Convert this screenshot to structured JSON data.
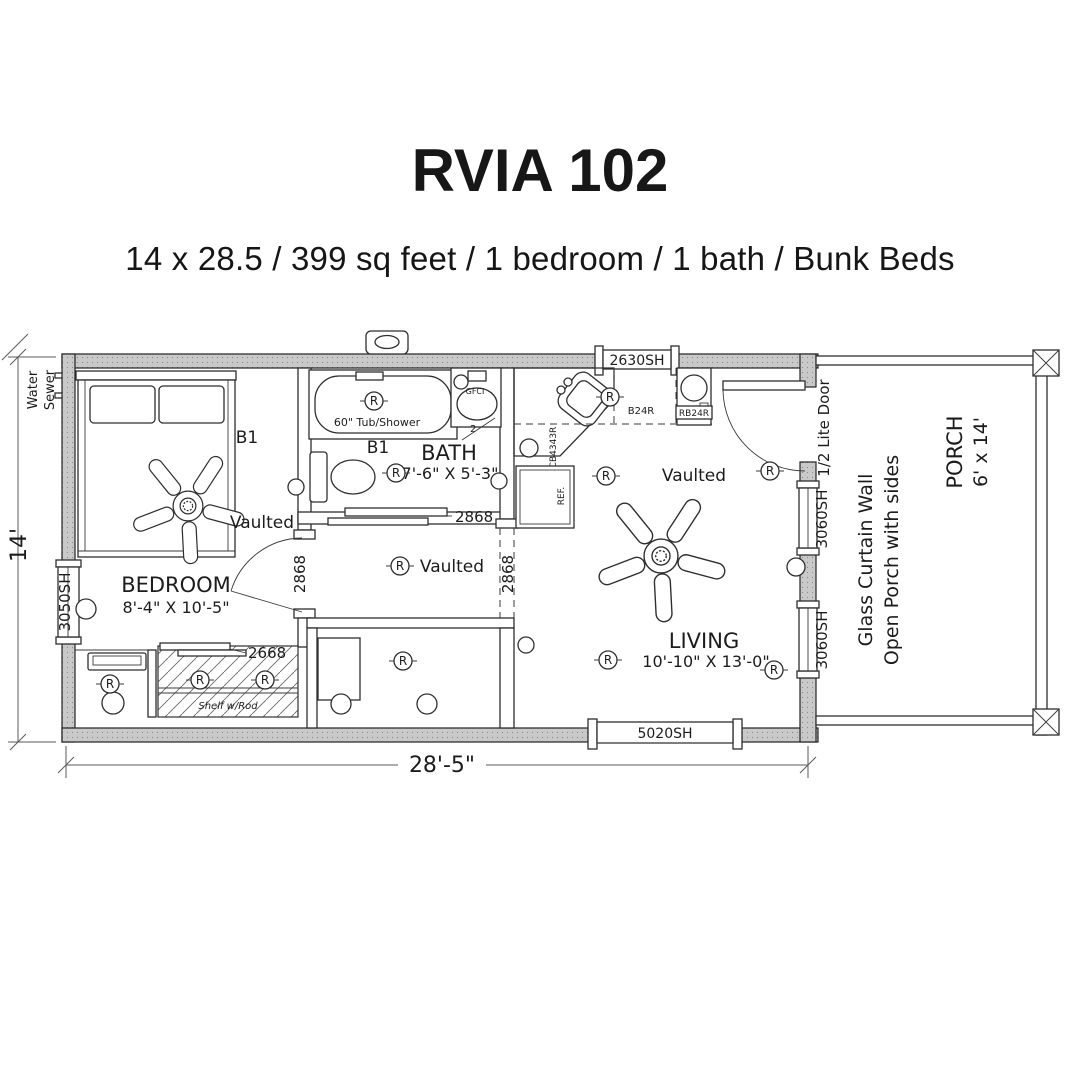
{
  "header": {
    "title": "RVIA 102",
    "subtitle": "14 x 28.5 / 399 sq feet / 1 bedroom / 1 bath / Bunk Beds"
  },
  "plan": {
    "dimensions": {
      "width": "28'-5\"",
      "height": "14'"
    },
    "utilities": {
      "water": "Water",
      "sewer": "Sewer"
    },
    "symbols": {
      "receptacle": "R"
    },
    "bedroom": {
      "name": "BEDROOM",
      "size": "8'-4\" X 10'-5\"",
      "bunk_label": "B1",
      "ceiling": "Vaulted",
      "window": "3050SH",
      "door": "2868",
      "closet_door": "2668",
      "closet_shelf": "Shelf w/Rod"
    },
    "bath": {
      "name": "BATH",
      "size": "7'-6\" X 5'-3\"",
      "bunk_label": "B1",
      "tub": "60\" Tub/Shower",
      "gfci": "GFCI",
      "door": "2868",
      "step_note": "2"
    },
    "hall": {
      "ceiling": "Vaulted",
      "opening": "2868"
    },
    "kitchen": {
      "corner_cabinet": "LCB4343R",
      "base_cabinet": "B24R",
      "range_cabinet": "RB24R",
      "fridge": "REF.",
      "window": "2630SH"
    },
    "living": {
      "name": "LIVING",
      "size": "10'-10\" X 13'-0\"",
      "ceiling": "Vaulted",
      "entry_door": "1/2 Lite Door",
      "window_side": "3060SH",
      "window_front": "5020SH"
    },
    "porch": {
      "name": "PORCH",
      "size": "6' x 14'",
      "note_line1": "Glass Curtain Wall",
      "note_line2": "Open Porch with sides"
    }
  }
}
